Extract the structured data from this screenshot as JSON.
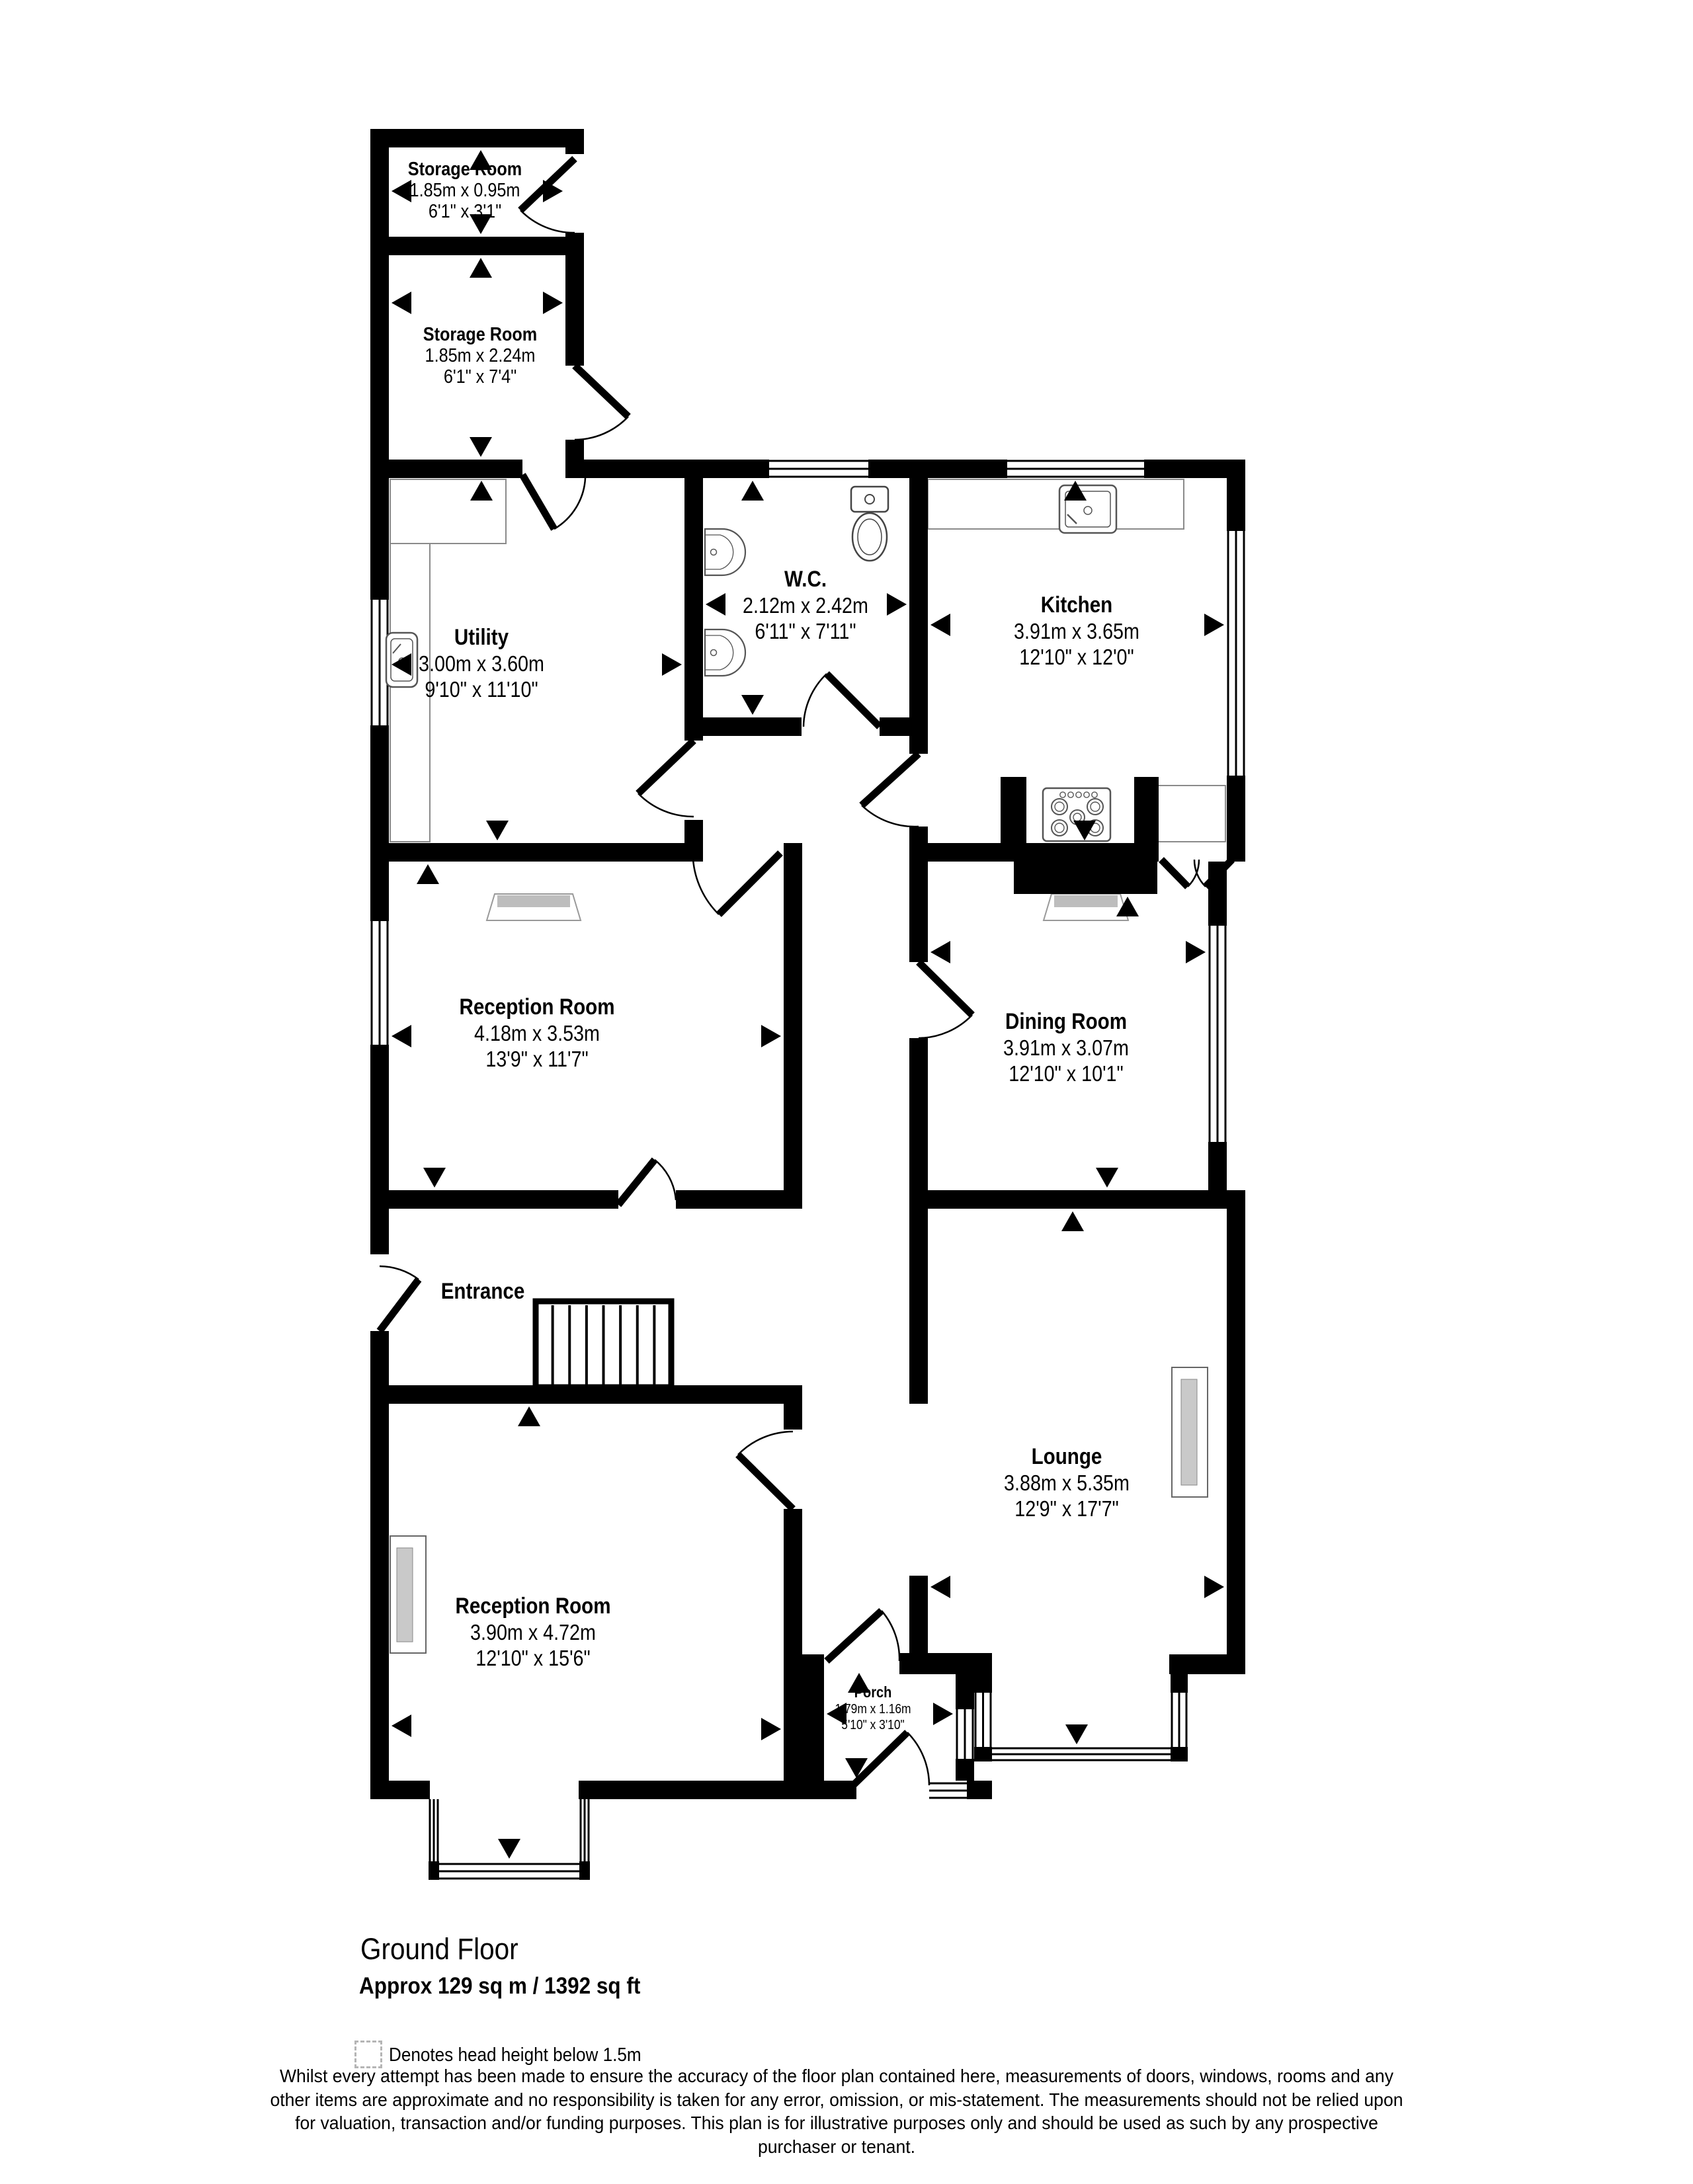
{
  "page": {
    "background": "#ffffff",
    "wall_color": "#000000",
    "hearth_gray": "#bdbdbd",
    "pane_gray": "#c9c9c9"
  },
  "rooms": {
    "storage1": {
      "name": "Storage Room",
      "metric": "1.85m x 0.95m",
      "imperial": "6'1\" x 3'1\""
    },
    "storage2": {
      "name": "Storage Room",
      "metric": "1.85m x 2.24m",
      "imperial": "6'1\" x 7'4\""
    },
    "utility": {
      "name": "Utility",
      "metric": "3.00m x 3.60m",
      "imperial": "9'10\" x 11'10\""
    },
    "wc": {
      "name": "W.C.",
      "metric": "2.12m x 2.42m",
      "imperial": "6'11\" x 7'11\""
    },
    "kitchen": {
      "name": "Kitchen",
      "metric": "3.91m x 3.65m",
      "imperial": "12'10\" x 12'0\""
    },
    "reception1": {
      "name": "Reception Room",
      "metric": "4.18m x 3.53m",
      "imperial": "13'9\" x 11'7\""
    },
    "dining": {
      "name": "Dining Room",
      "metric": "3.91m x 3.07m",
      "imperial": "12'10\" x 10'1\""
    },
    "entrance": {
      "name": "Entrance"
    },
    "lounge": {
      "name": "Lounge",
      "metric": "3.88m x 5.35m",
      "imperial": "12'9\" x 17'7\""
    },
    "reception2": {
      "name": "Reception Room",
      "metric": "3.90m x 4.72m",
      "imperial": "12'10\" x 15'6\""
    },
    "porch": {
      "name": "Porch",
      "metric": "1.79m x 1.16m",
      "imperial": "5'10\" x 3'10\""
    }
  },
  "footer": {
    "floor_title": "Ground Floor",
    "floor_area": "Approx 129 sq m / 1392 sq ft",
    "legend": "Denotes head height below 1.5m",
    "disclaimer": "Whilst every attempt has been made to ensure the accuracy of the floor plan contained here, measurements of doors, windows, rooms and any other items are approximate and no responsibility is taken for any error, omission, or mis-statement. The measurements should not be relied upon for valuation, transaction and/or funding purposes. This plan is for illustrative purposes only and should be used as such by any prospective purchaser or tenant."
  }
}
